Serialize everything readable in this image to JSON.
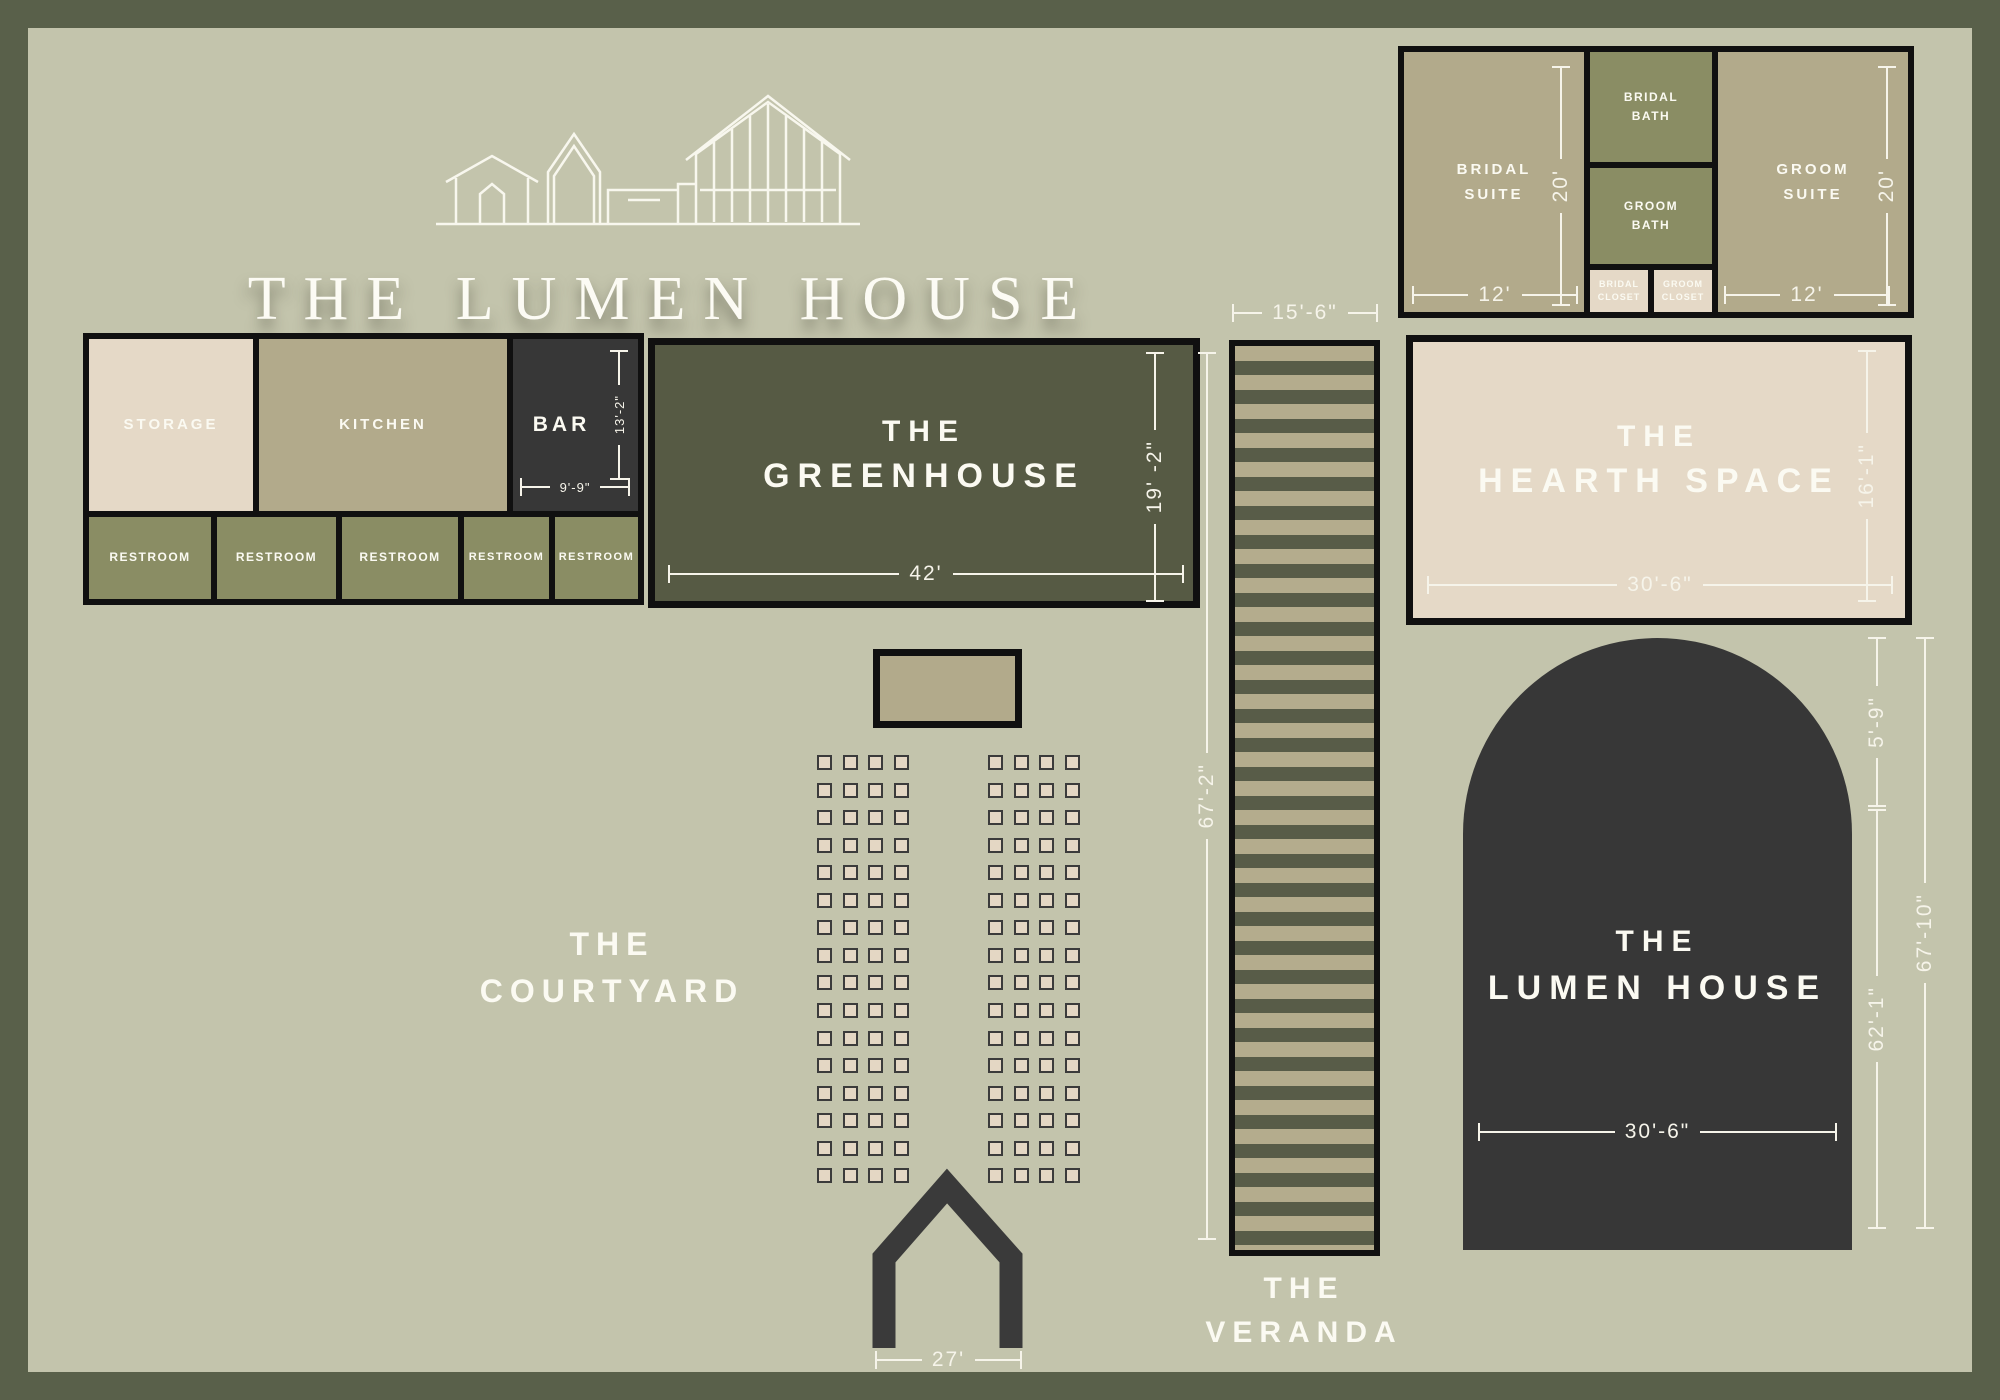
{
  "meta": {
    "venue_title": "THE LUMEN HOUSE"
  },
  "palette": {
    "frame": "#59604a",
    "background": "#c3c4ac",
    "room_outline": "#101010",
    "tan_room": "#b2aa8b",
    "olive_room": "#8a8d64",
    "cream_room": "#e5d9c7",
    "dark_room": "#373737",
    "greenhouse_room": "#565a44",
    "veranda_stripe_light": "#b4ac8d",
    "veranda_stripe_dark": "#585c48",
    "chair_fill": "#e4d7c4",
    "label_text": "#fbfaf2",
    "dimension_lines": "#f6f4ea"
  },
  "suites": {
    "bridal_suite": {
      "line1": "BRIDAL",
      "line2": "SUITE",
      "width": "12'",
      "height": "20'"
    },
    "bridal_bath": {
      "line1": "BRIDAL",
      "line2": "BATH"
    },
    "groom_bath": {
      "line1": "GROOM",
      "line2": "BATH"
    },
    "bridal_closet": {
      "line1": "BRIDAL",
      "line2": "CLOSET"
    },
    "groom_closet": {
      "line1": "GROOM",
      "line2": "CLOSET"
    },
    "groom_suite": {
      "line1": "GROOM",
      "line2": "SUITE",
      "width": "12'",
      "height": "20'"
    }
  },
  "service": {
    "storage": {
      "label": "STORAGE"
    },
    "kitchen": {
      "label": "KITCHEN"
    },
    "bar": {
      "label": "BAR",
      "width": "9'-9\"",
      "height": "13'-2\""
    },
    "restrooms": {
      "label": "RESTROOM",
      "count": 5
    }
  },
  "greenhouse": {
    "line1": "THE",
    "line2": "GREENHOUSE",
    "width": "42'",
    "height": "19' -2\""
  },
  "veranda": {
    "line1": "THE",
    "line2": "VERANDA",
    "width": "15'-6\"",
    "height": "67'-2\""
  },
  "hearth": {
    "line1": "THE",
    "line2": "HEARTH SPACE",
    "width": "30'-6\"",
    "height": "16'-1\""
  },
  "lumen_house": {
    "line1": "THE",
    "line2": "LUMEN HOUSE",
    "width": "30'-6\"",
    "height_upper": "5'-9\"",
    "height_lower": "62'-1\"",
    "height_total": "67'-10\""
  },
  "courtyard": {
    "line1": "THE",
    "line2": "COURTYARD",
    "arbor_width": "27'",
    "seating": {
      "rows": 16,
      "columns_per_side": 4,
      "sides": 2,
      "total_chairs": 128
    }
  }
}
